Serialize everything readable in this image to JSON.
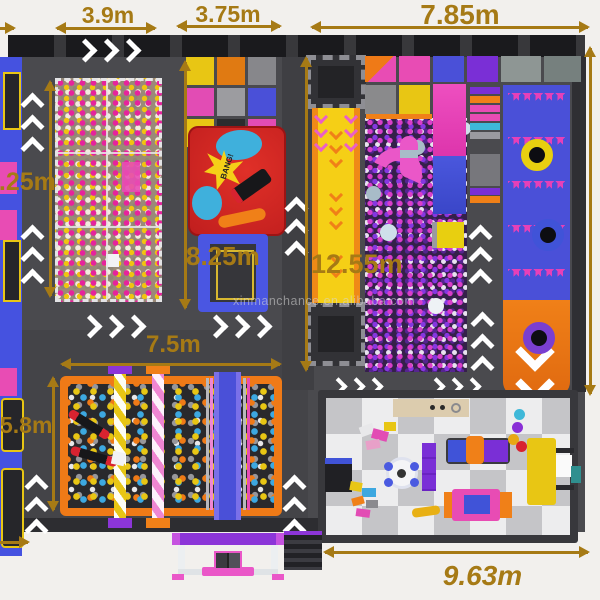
{
  "title": "indoor-playground-floor-plan",
  "watermark": "xinmanchance.en.alibaba.com",
  "dimensions": {
    "top_ballpit_width": "3.9m",
    "top_graffiti_width": "3.75m",
    "top_right_width": "7.85m",
    "left_height": "8.25m",
    "graffiti_zone_height": "8.25m",
    "tumble_track_length": "12.55m",
    "foam_pit_width": "7.5m",
    "foam_pit_height": "5.8m",
    "bottom_right_width": "9.63m"
  },
  "graffiti_mat": {
    "text": "BANG!"
  },
  "palette": {
    "dimension_gold": "#a67a15",
    "floor_dark": "#4a4a4e",
    "wall_dark": "#242427",
    "accent_blue": "#4552e0",
    "accent_pink": "#e84cb4",
    "accent_purple": "#7a2fd6",
    "accent_orange": "#ef7a17",
    "accent_yellow": "#e8c614"
  }
}
